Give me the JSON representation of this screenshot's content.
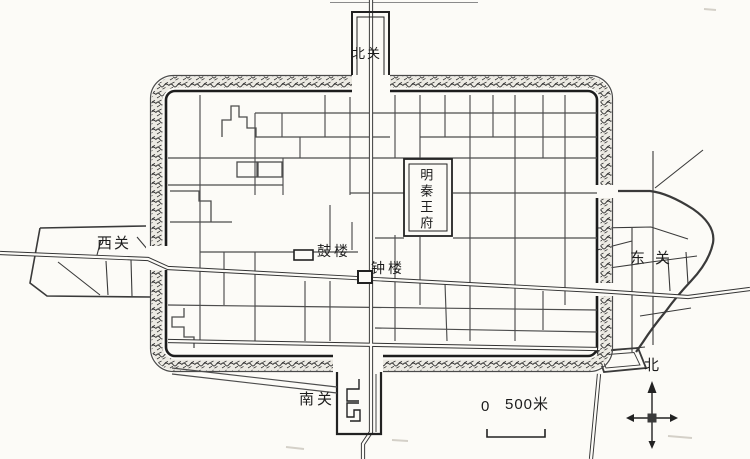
{
  "labels": {
    "north_guan": "北关",
    "south_guan": "南关",
    "west_guan": "西关",
    "east_guan": "东关",
    "palace": "明秦王府",
    "drum_tower": "鼓楼",
    "bell_tower": "钟楼",
    "compass_north": "北"
  },
  "scale_bar": {
    "start": "0",
    "end": "500米"
  },
  "colors": {
    "paper": "#fcfbf7",
    "ink": "#222222",
    "wall_hatch": "#2e2e2e",
    "street": "#4d4d4d"
  }
}
